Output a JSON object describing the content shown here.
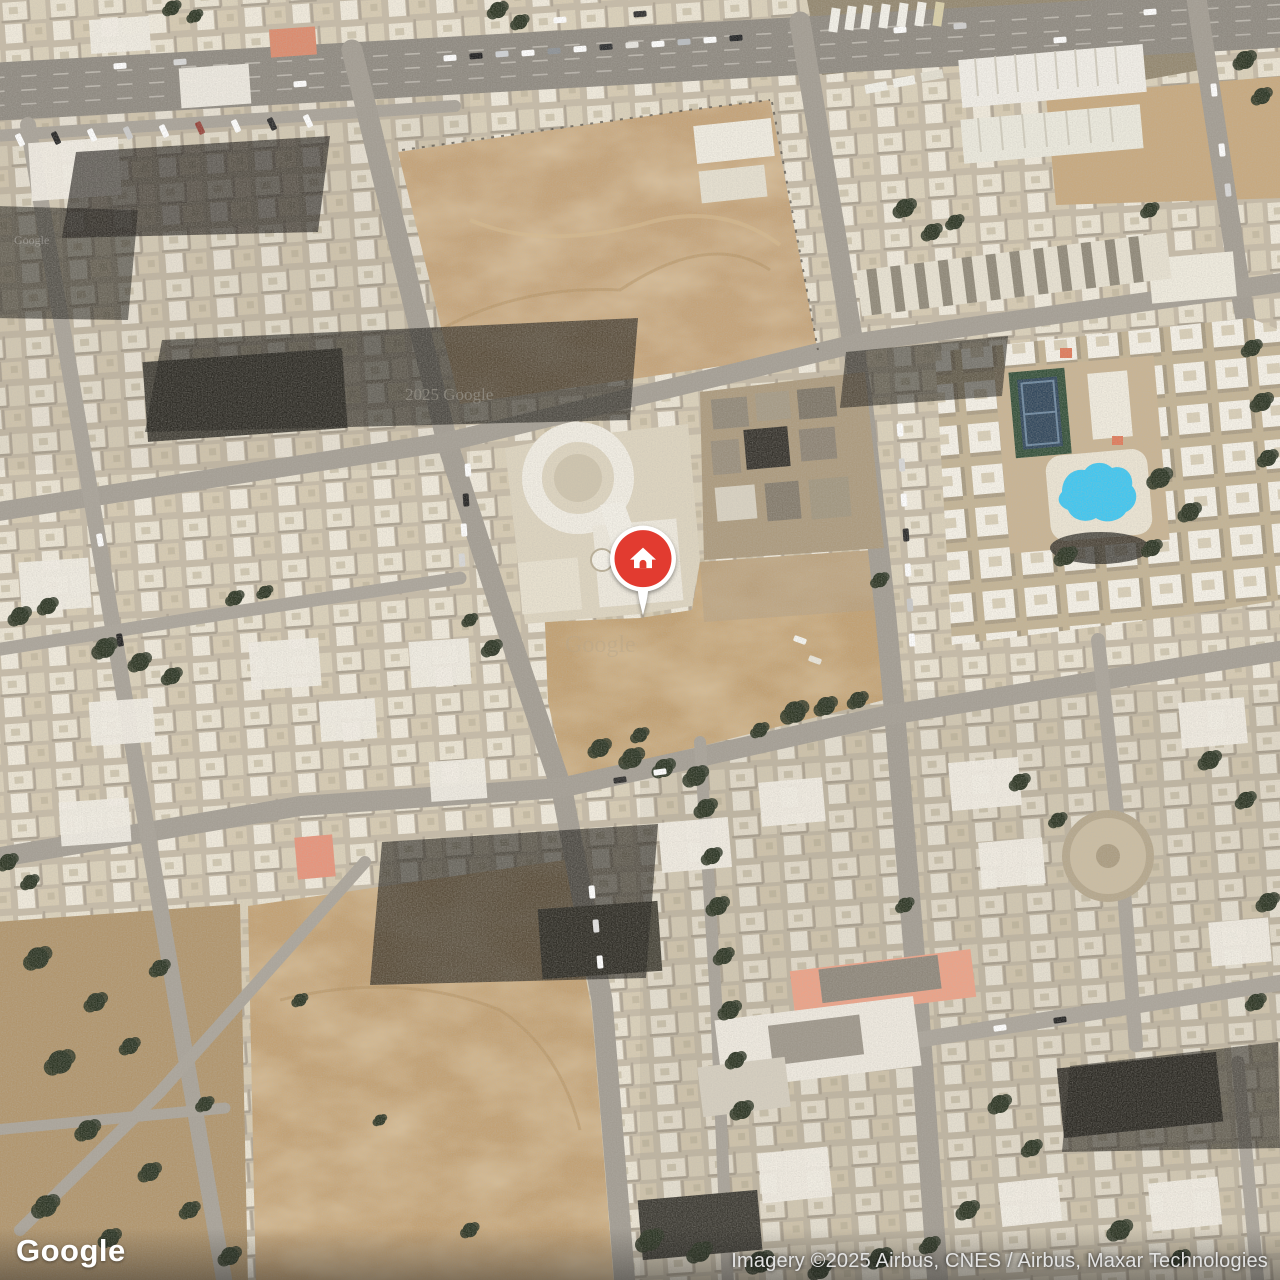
{
  "map": {
    "view_type": "satellite",
    "marker": {
      "icon": "home",
      "x": 643,
      "y": 577,
      "color": "#E23B30",
      "ring_color": "#FFFFFF"
    },
    "watermarks": {
      "shadow_block": "2025 Google",
      "dirt_emboss": "Google",
      "small_left": "Google"
    },
    "palette": {
      "dirt": "#C5A378",
      "road": "#A29C92",
      "highway": "#8E8980",
      "building_light": "#F2EDE1",
      "building_base": "#C6BBA7",
      "shadow": "#23211D",
      "tree": "#2C3524",
      "pool": "#3EC7F2",
      "tennis_court": "#31475C",
      "salmon_roof": "#EDA287"
    }
  },
  "footer": {
    "logo_text": "Google",
    "attribution": "Imagery ©2025 Airbus, CNES / Airbus, Maxar Technologies"
  }
}
